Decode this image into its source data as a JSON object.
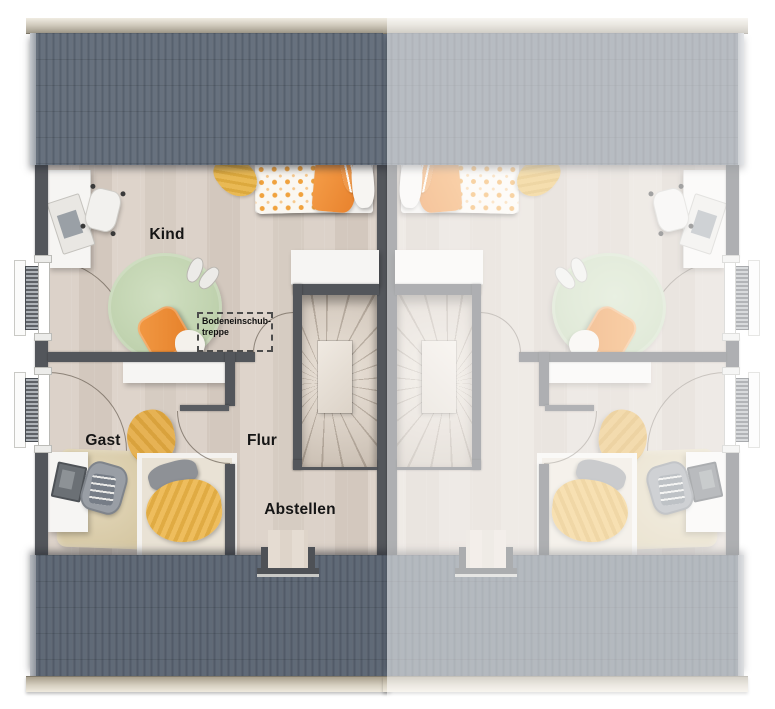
{
  "labels": {
    "kind": "Kind",
    "gast": "Gast",
    "flur": "Flur",
    "abstellen": "Abstellen",
    "attic_line1": "Bodeneinschub-",
    "attic_line2": "treppe"
  },
  "plan": {
    "type": "floorplan-top-view",
    "left_unit_rooms": [
      "Kind",
      "Gast",
      "Flur",
      "Abstellen"
    ],
    "right_unit": "mirrored duplicate, faded, no labels",
    "annotation": "Bodeneinschub-treppe (dashed attic-hatch outline)"
  },
  "colors": {
    "roof": "#5c6672",
    "wall": "#53565b",
    "floor_wood": "#d8cec5",
    "ridge_cap": "#cfc8ba",
    "rug_green": "#c6d6b7",
    "accent_orange": "#ee8c3d",
    "blanket_yellow": "#eebb5c",
    "rug_beige": "#ded2b2",
    "stair_wood": "#d9cfc5",
    "fade_overlay": "rgba(255,255,255,0.53)"
  }
}
